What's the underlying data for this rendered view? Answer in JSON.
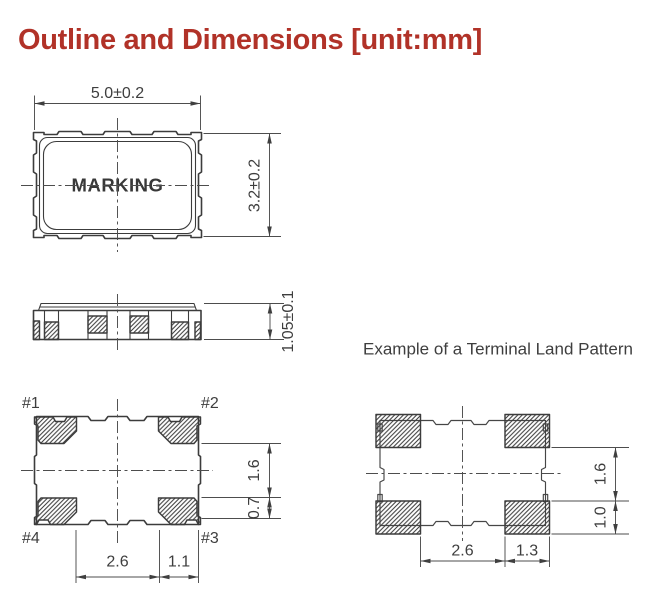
{
  "title": "Outline and Dimensions [unit:mm]",
  "colors": {
    "accent": "#b13228",
    "line": "#3c3c3c"
  },
  "top_view": {
    "marking": "MARKING",
    "width_dim": "5.0±0.2",
    "height_dim": "3.2±0.2"
  },
  "side_view": {
    "height_dim": "1.05±0.1"
  },
  "bottom_view": {
    "pin1": "#1",
    "pin2": "#2",
    "pin3": "#3",
    "pin4": "#4",
    "pad_pitch": "2.6",
    "pad_width": "1.1",
    "pad_gap_v": "1.6",
    "pad_height": "0.7"
  },
  "land_pattern": {
    "caption": "Example of a Terminal Land Pattern",
    "pad_pitch": "2.6",
    "pad_width": "1.3",
    "pad_gap_v": "1.6",
    "pad_height": "1.0"
  }
}
